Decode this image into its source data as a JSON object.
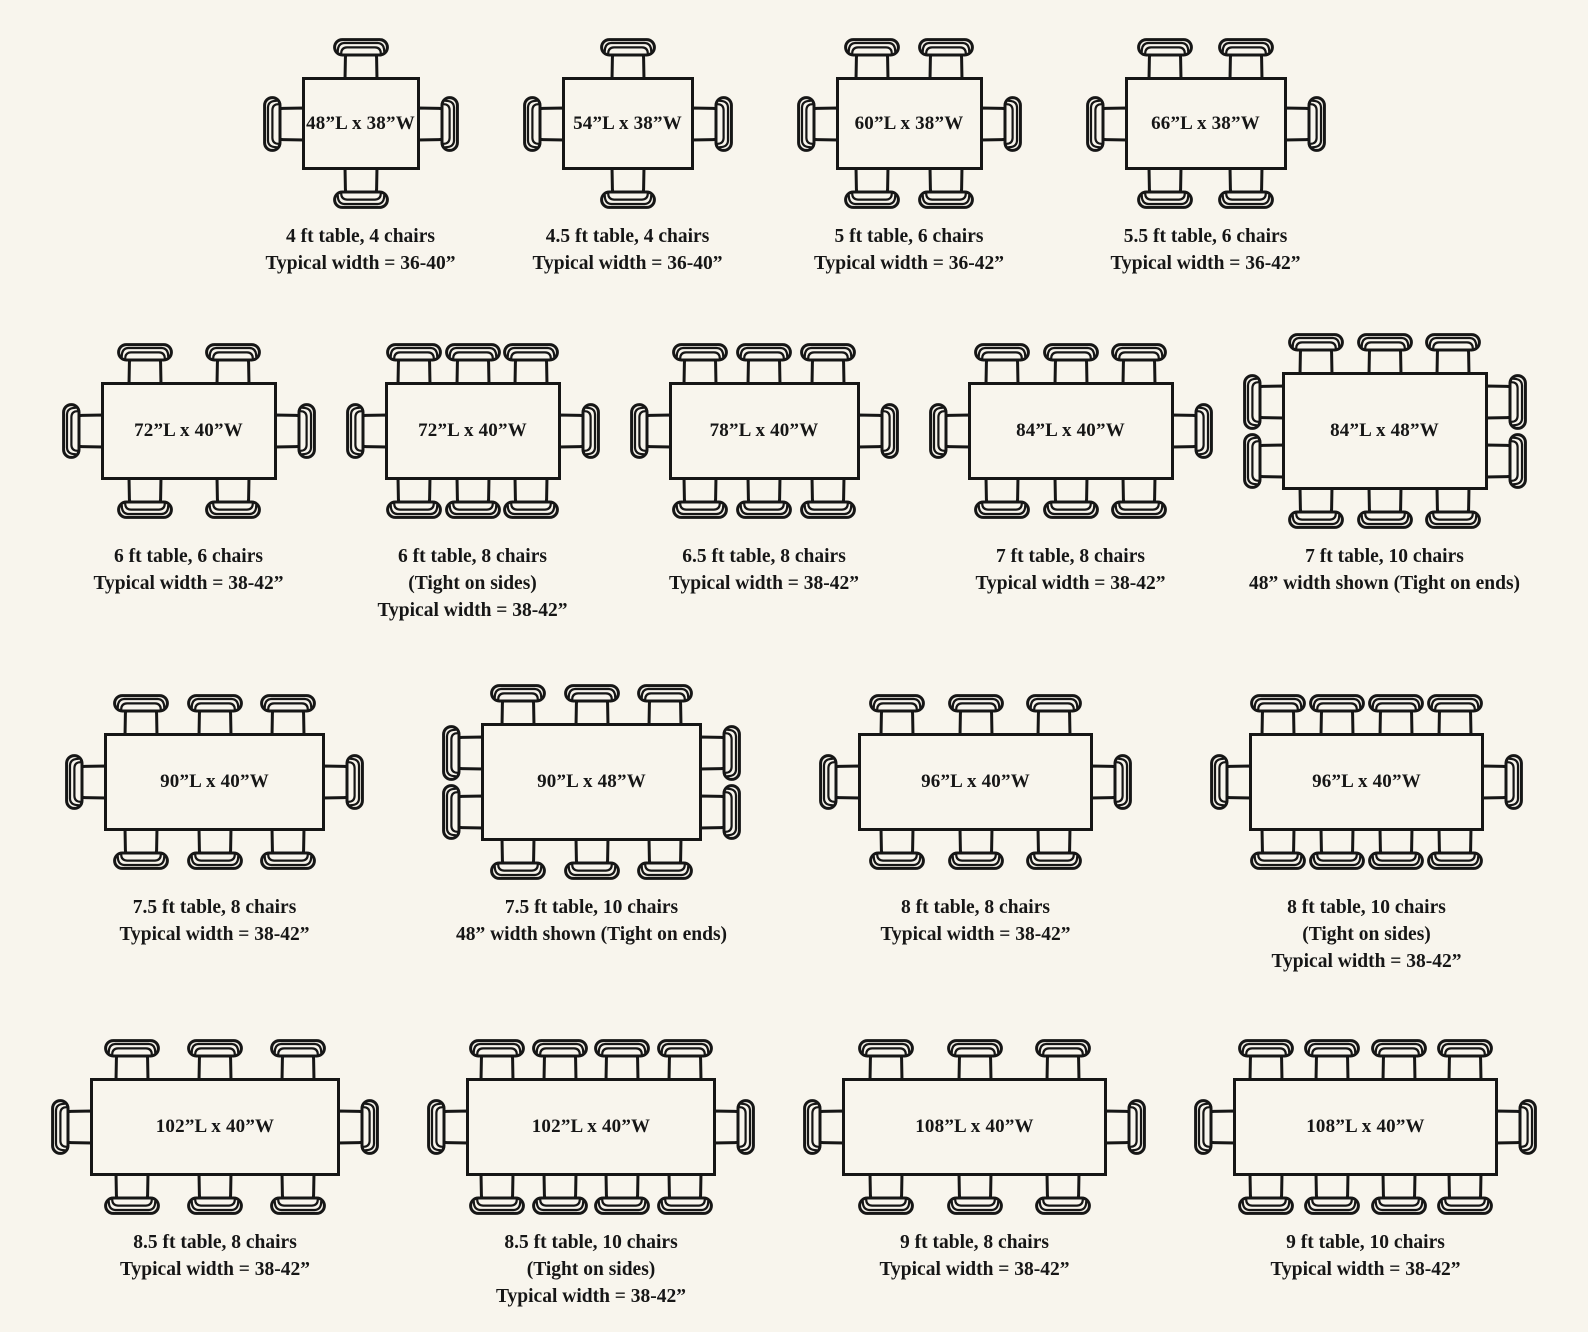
{
  "page": {
    "background_color": "#f8f5ed",
    "line_color": "#161616",
    "description": "Dining table sizes and chair seating arrangement diagrams"
  },
  "rows": [
    {
      "figures": [
        {
          "label": "48”L x 38”W",
          "length_in": 48,
          "width_in": 38,
          "chairs": {
            "top": 1,
            "bottom": 1,
            "left": 1,
            "right": 1
          },
          "caption": [
            "4 ft table, 4 chairs",
            "Typical width = 36-40”"
          ]
        },
        {
          "label": "54”L x 38”W",
          "length_in": 54,
          "width_in": 38,
          "chairs": {
            "top": 1,
            "bottom": 1,
            "left": 1,
            "right": 1
          },
          "caption": [
            "4.5 ft table, 4 chairs",
            "Typical width = 36-40”"
          ]
        },
        {
          "label": "60”L x 38”W",
          "length_in": 60,
          "width_in": 38,
          "chairs": {
            "top": 2,
            "bottom": 2,
            "left": 1,
            "right": 1
          },
          "caption": [
            "5 ft table, 6 chairs",
            "Typical width = 36-42”"
          ]
        },
        {
          "label": "66”L x 38”W",
          "length_in": 66,
          "width_in": 38,
          "chairs": {
            "top": 2,
            "bottom": 2,
            "left": 1,
            "right": 1
          },
          "caption": [
            "5.5 ft table, 6 chairs",
            "Typical width = 36-42”"
          ]
        }
      ]
    },
    {
      "figures": [
        {
          "label": "72”L x 40”W",
          "length_in": 72,
          "width_in": 40,
          "chairs": {
            "top": 2,
            "bottom": 2,
            "left": 1,
            "right": 1
          },
          "caption": [
            "6 ft table, 6 chairs",
            "Typical width = 38-42”"
          ]
        },
        {
          "label": "72”L x 40”W",
          "length_in": 72,
          "width_in": 40,
          "chairs": {
            "top": 3,
            "bottom": 3,
            "left": 1,
            "right": 1
          },
          "caption": [
            "6 ft table, 8 chairs",
            "(Tight on sides)",
            "Typical width = 38-42”"
          ]
        },
        {
          "label": "78”L x 40”W",
          "length_in": 78,
          "width_in": 40,
          "chairs": {
            "top": 3,
            "bottom": 3,
            "left": 1,
            "right": 1
          },
          "caption": [
            "6.5 ft table, 8 chairs",
            "Typical width = 38-42”"
          ]
        },
        {
          "label": "84”L x 40”W",
          "length_in": 84,
          "width_in": 40,
          "chairs": {
            "top": 3,
            "bottom": 3,
            "left": 1,
            "right": 1
          },
          "caption": [
            "7 ft table, 8 chairs",
            "Typical width = 38-42”"
          ]
        },
        {
          "label": "84”L x 48”W",
          "length_in": 84,
          "width_in": 48,
          "chairs": {
            "top": 3,
            "bottom": 3,
            "left": 2,
            "right": 2
          },
          "caption": [
            "7 ft table, 10 chairs",
            "48” width shown (Tight on ends)"
          ]
        }
      ]
    },
    {
      "figures": [
        {
          "label": "90”L x 40”W",
          "length_in": 90,
          "width_in": 40,
          "chairs": {
            "top": 3,
            "bottom": 3,
            "left": 1,
            "right": 1
          },
          "caption": [
            "7.5 ft table, 8 chairs",
            "Typical width = 38-42”"
          ]
        },
        {
          "label": "90”L x 48”W",
          "length_in": 90,
          "width_in": 48,
          "chairs": {
            "top": 3,
            "bottom": 3,
            "left": 2,
            "right": 2
          },
          "caption": [
            "7.5 ft table, 10 chairs",
            "48” width shown (Tight on ends)"
          ]
        },
        {
          "label": "96”L x 40”W",
          "length_in": 96,
          "width_in": 40,
          "chairs": {
            "top": 3,
            "bottom": 3,
            "left": 1,
            "right": 1
          },
          "caption": [
            "8 ft table, 8 chairs",
            "Typical width = 38-42”"
          ]
        },
        {
          "label": "96”L x 40”W",
          "length_in": 96,
          "width_in": 40,
          "chairs": {
            "top": 4,
            "bottom": 4,
            "left": 1,
            "right": 1
          },
          "caption": [
            "8 ft table, 10 chairs",
            "(Tight on sides)",
            "Typical width = 38-42”"
          ]
        }
      ]
    },
    {
      "figures": [
        {
          "label": "102”L x 40”W",
          "length_in": 102,
          "width_in": 40,
          "chairs": {
            "top": 3,
            "bottom": 3,
            "left": 1,
            "right": 1
          },
          "caption": [
            "8.5 ft table, 8 chairs",
            "Typical width = 38-42”"
          ]
        },
        {
          "label": "102”L x 40”W",
          "length_in": 102,
          "width_in": 40,
          "chairs": {
            "top": 4,
            "bottom": 4,
            "left": 1,
            "right": 1
          },
          "caption": [
            "8.5 ft table, 10 chairs",
            "(Tight on sides)",
            "Typical width = 38-42”"
          ]
        },
        {
          "label": "108”L x 40”W",
          "length_in": 108,
          "width_in": 40,
          "chairs": {
            "top": 3,
            "bottom": 3,
            "left": 1,
            "right": 1
          },
          "caption": [
            "9 ft table, 8 chairs",
            "Typical width = 38-42”"
          ]
        },
        {
          "label": "108”L x 40”W",
          "length_in": 108,
          "width_in": 40,
          "chairs": {
            "top": 4,
            "bottom": 4,
            "left": 1,
            "right": 1
          },
          "caption": [
            "9 ft table, 10 chairs",
            "Typical width = 38-42”"
          ]
        }
      ]
    }
  ]
}
